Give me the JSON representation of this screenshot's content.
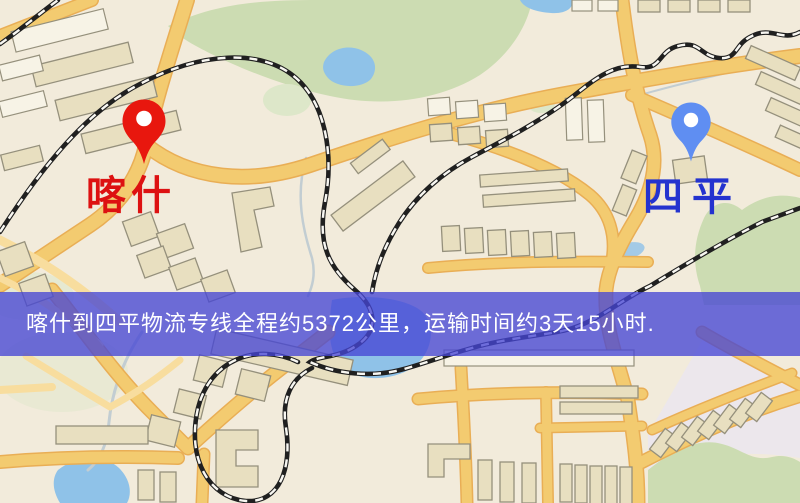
{
  "map": {
    "markers": [
      {
        "id": "origin",
        "label": "喀什",
        "pin_color": "#e8170e",
        "label_color": "#dd1111"
      },
      {
        "id": "destination",
        "label": "四平",
        "pin_color": "#5f8ef2",
        "label_color": "#2433cf"
      }
    ],
    "banner": {
      "text": "喀什到四平物流专线全程约5372公里，运输时间约3天15小时.",
      "bg_color": "#4646d4c6",
      "text_color": "#ffffff"
    },
    "colors": {
      "background": "#f2ebdb",
      "road": "#f3cb70",
      "road_light": "#f8dd9e",
      "road_casing": "#e9ae55",
      "building": "#e8dfc0",
      "building_light": "#f7f3e6",
      "building_stroke": "#95907c",
      "park": "#ccdcb2",
      "park_light": "#dde7c9",
      "lavender": "#e9e6f1",
      "water": "#8fc2e8",
      "railway": "#202020",
      "railway_dash": "#f8f7f2",
      "stream": "#c2cdd2"
    }
  }
}
